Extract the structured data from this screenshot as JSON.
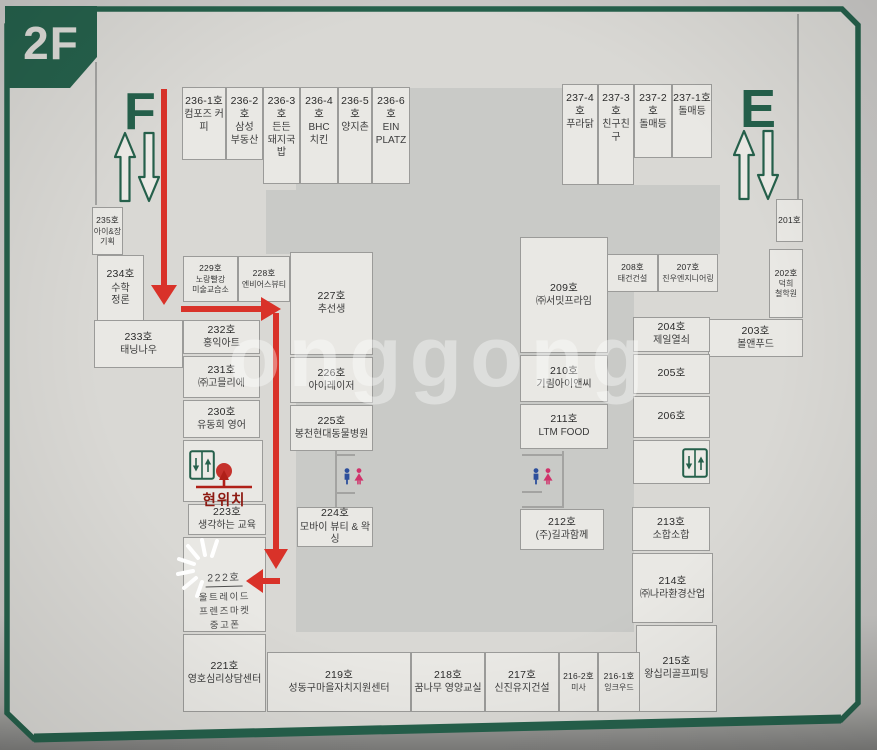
{
  "floor_label": "2F",
  "stairs": {
    "f_label": "F",
    "e_label": "E"
  },
  "marker": {
    "current_location": "현위치"
  },
  "watermark": "onggong",
  "colors": {
    "sign_green": "#25604b",
    "route_red": "#d93229",
    "marker_red": "#8e1a12",
    "toilet_blue": "#2d4f9c",
    "toilet_pink": "#d0336b"
  },
  "icons": {
    "elevator": "elevator-icon",
    "toilet": "toilet-icon",
    "stairs_up": "up-arrow",
    "stairs_down": "down-arrow",
    "current_location_dot": "red-dot"
  },
  "units": {
    "u236_1": {
      "no": "236-1호",
      "name": "컴포즈 커피"
    },
    "u236_2": {
      "no": "236-2호",
      "name": "삼성\n부동산"
    },
    "u236_3": {
      "no": "236-3호",
      "name": "든든\n돼지국밥"
    },
    "u236_4": {
      "no": "236-4호",
      "name": "BHC\n치킨"
    },
    "u236_5": {
      "no": "236-5호",
      "name": "양지촌"
    },
    "u236_6": {
      "no": "236-6호",
      "name": "EIN\nPLATZ"
    },
    "u237_4": {
      "no": "237-4호",
      "name": "푸라닭"
    },
    "u237_3": {
      "no": "237-3호",
      "name": "친구친구"
    },
    "u237_2": {
      "no": "237-2호",
      "name": "돌매등"
    },
    "u237_1": {
      "no": "237-1호",
      "name": "돌매등"
    },
    "u235": {
      "no": "235호",
      "name": "아이&장\n기획"
    },
    "u234": {
      "no": "234호",
      "name": "수학\n정론"
    },
    "u233": {
      "no": "233호",
      "name": "태닝나우"
    },
    "u232": {
      "no": "232호",
      "name": "홍익아트"
    },
    "u231": {
      "no": "231호",
      "name": "㈜고믈리에"
    },
    "u230": {
      "no": "230호",
      "name": "유동희 영어"
    },
    "u229": {
      "no": "229호",
      "name": "노랑빨강\n미술교습소"
    },
    "u228": {
      "no": "228호",
      "name": "엔비어스뷰티"
    },
    "u227": {
      "no": "227호",
      "name": "추선생"
    },
    "u226": {
      "no": "226호",
      "name": "아이레이저"
    },
    "u225": {
      "no": "225호",
      "name": "봉천현대동물병원"
    },
    "u224": {
      "no": "224호",
      "name": "모바이 뷰티 & 왁싱"
    },
    "u223": {
      "no": "223호",
      "name": "생각하는 교육"
    },
    "u222": {
      "no": "222호",
      "name": "울트레이드\n프렌즈마켓\n중고폰"
    },
    "u221": {
      "no": "221호",
      "name": "영호심리상담센터"
    },
    "u219": {
      "no": "219호",
      "name": "성동구마을자치지원센터"
    },
    "u218": {
      "no": "218호",
      "name": "꿈나무 영양교실"
    },
    "u217": {
      "no": "217호",
      "name": "신진유지건설"
    },
    "u216_2": {
      "no": "216-2호",
      "name": "미사"
    },
    "u216_1": {
      "no": "216-1호",
      "name": "잉크우드"
    },
    "u215": {
      "no": "215호",
      "name": "왕십리골프피팅"
    },
    "u214": {
      "no": "214호",
      "name": "㈜나라환경산업"
    },
    "u213": {
      "no": "213호",
      "name": "소합소합"
    },
    "u212": {
      "no": "212호",
      "name": "(주)길과함께"
    },
    "u211": {
      "no": "211호",
      "name": "LTM FOOD"
    },
    "u210": {
      "no": "210호",
      "name": "기림아이앤씨"
    },
    "u209": {
      "no": "209호",
      "name": "㈜서밋프라임"
    },
    "u208": {
      "no": "208호",
      "name": "태건건설"
    },
    "u207": {
      "no": "207호",
      "name": "진우엔지니어링"
    },
    "u206": {
      "no": "206호",
      "name": ""
    },
    "u205": {
      "no": "205호",
      "name": ""
    },
    "u204": {
      "no": "204호",
      "name": "제일열쇠"
    },
    "u203": {
      "no": "203호",
      "name": "볼앤푸드"
    },
    "u202": {
      "no": "202호",
      "name": "덕희\n철학원"
    },
    "u201": {
      "no": "201호",
      "name": ""
    }
  }
}
